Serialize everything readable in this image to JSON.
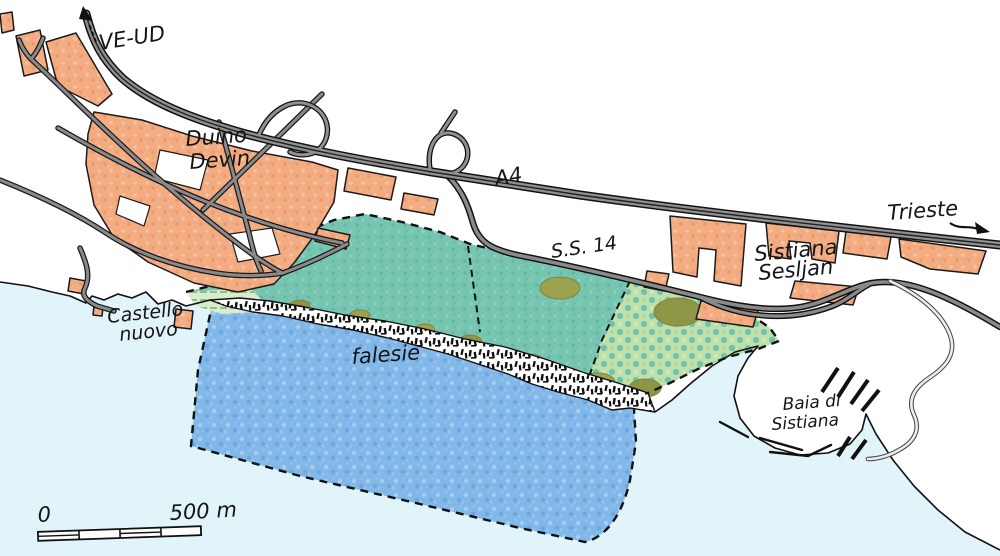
{
  "map": {
    "labels": {
      "ve_ud": "VE-UD",
      "duino": [
        "Duino",
        "Devin"
      ],
      "a4": "A4",
      "trieste": "Trieste",
      "ss14": "S.S. 14",
      "sistiana": [
        "Sistiana",
        "Sesljan"
      ],
      "castello": [
        "Castello",
        "nuovo"
      ],
      "falesie": "falesie",
      "baia": [
        "Baia di",
        "Sistiana"
      ]
    },
    "scale": {
      "start": "0",
      "end": "500 m"
    },
    "colors": {
      "sea": "#e0f4fa",
      "marine_reserve_blue": "#82b8e8",
      "land_reserve_teal": "#76c5b1",
      "karst_meadow_green": "#bfe0aa",
      "urban_orange": "#f3ac82",
      "road_gray": "#909090",
      "light_road_gray": "#ececec",
      "olive_scrub": "#9da24f",
      "ink": "#151515"
    }
  }
}
